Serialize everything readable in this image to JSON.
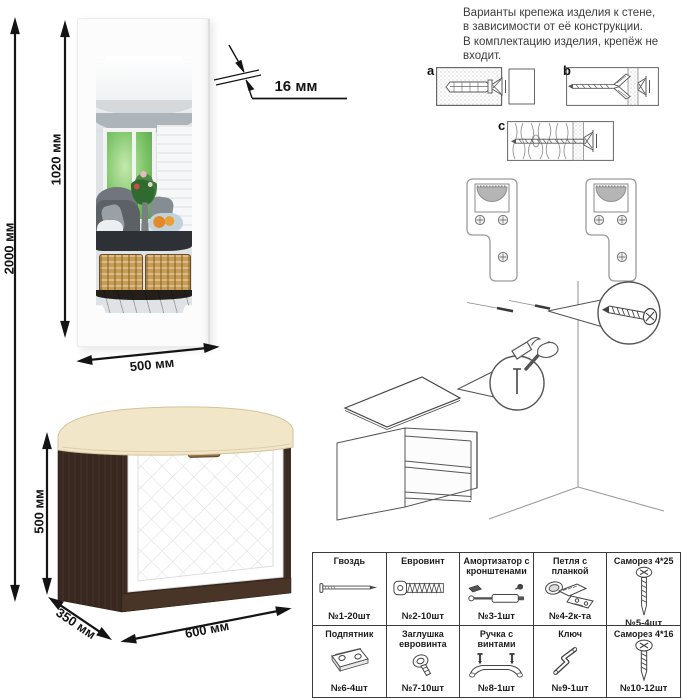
{
  "dimensions": {
    "total_height": "2000 мм",
    "mirror_panel_height": "1020 мм",
    "panel_thickness": "16 мм",
    "mirror_width": "500 мм",
    "bench_height": "500 мм",
    "bench_depth": "350 мм",
    "bench_width": "600 мм"
  },
  "mounting_note": "Варианты крепежа изделия к стене,\nв зависимости от её конструкции.\nВ комплектацию изделия, крепёж не\nвходит.",
  "wall_type_labels": {
    "a": "a",
    "b": "b",
    "c": "c"
  },
  "hardware_table": {
    "rows": [
      [
        {
          "name": "Гвоздь",
          "qty": "№1-20шт",
          "icon": "nail-icon"
        },
        {
          "name": "Евровинт",
          "qty": "№2-10шт",
          "icon": "euroscrew-icon"
        },
        {
          "name": "Амортизатор с кронштенами",
          "qty": "№3-1шт",
          "icon": "gas-strut-icon"
        },
        {
          "name": "Петля с планкой",
          "qty": "№4-2к-та",
          "icon": "hinge-icon"
        },
        {
          "name": "Саморез 4*25",
          "qty": "№5-4шт",
          "icon": "screw-4x25-icon"
        },
        {
          "name": "Подпятник",
          "qty": "№6-4шт",
          "icon": "glide-icon"
        },
        {
          "name": "Заглушка евровинта",
          "qty": "№7-10шт",
          "icon": "cap-icon"
        },
        {
          "name": "Ручка с винтами",
          "qty": "№8-1шт",
          "icon": "handle-icon"
        },
        {
          "name": "Ключ",
          "qty": "№9-1шт",
          "icon": "hex-key-icon"
        },
        {
          "name": "Саморез 4*16",
          "qty": "№10-12шт",
          "icon": "screw-4x16-icon"
        }
      ]
    ]
  },
  "colors": {
    "wenge_body": "#3a2a21",
    "wenge_plinth": "#463326",
    "cushion": "#f1e6c8",
    "door": "#ffffff",
    "dimension_lines": "#141414",
    "diagram_outline": "#555555",
    "bracket_outline": "#9a9a9a",
    "keyhole_fill": "#b5b5b5"
  }
}
